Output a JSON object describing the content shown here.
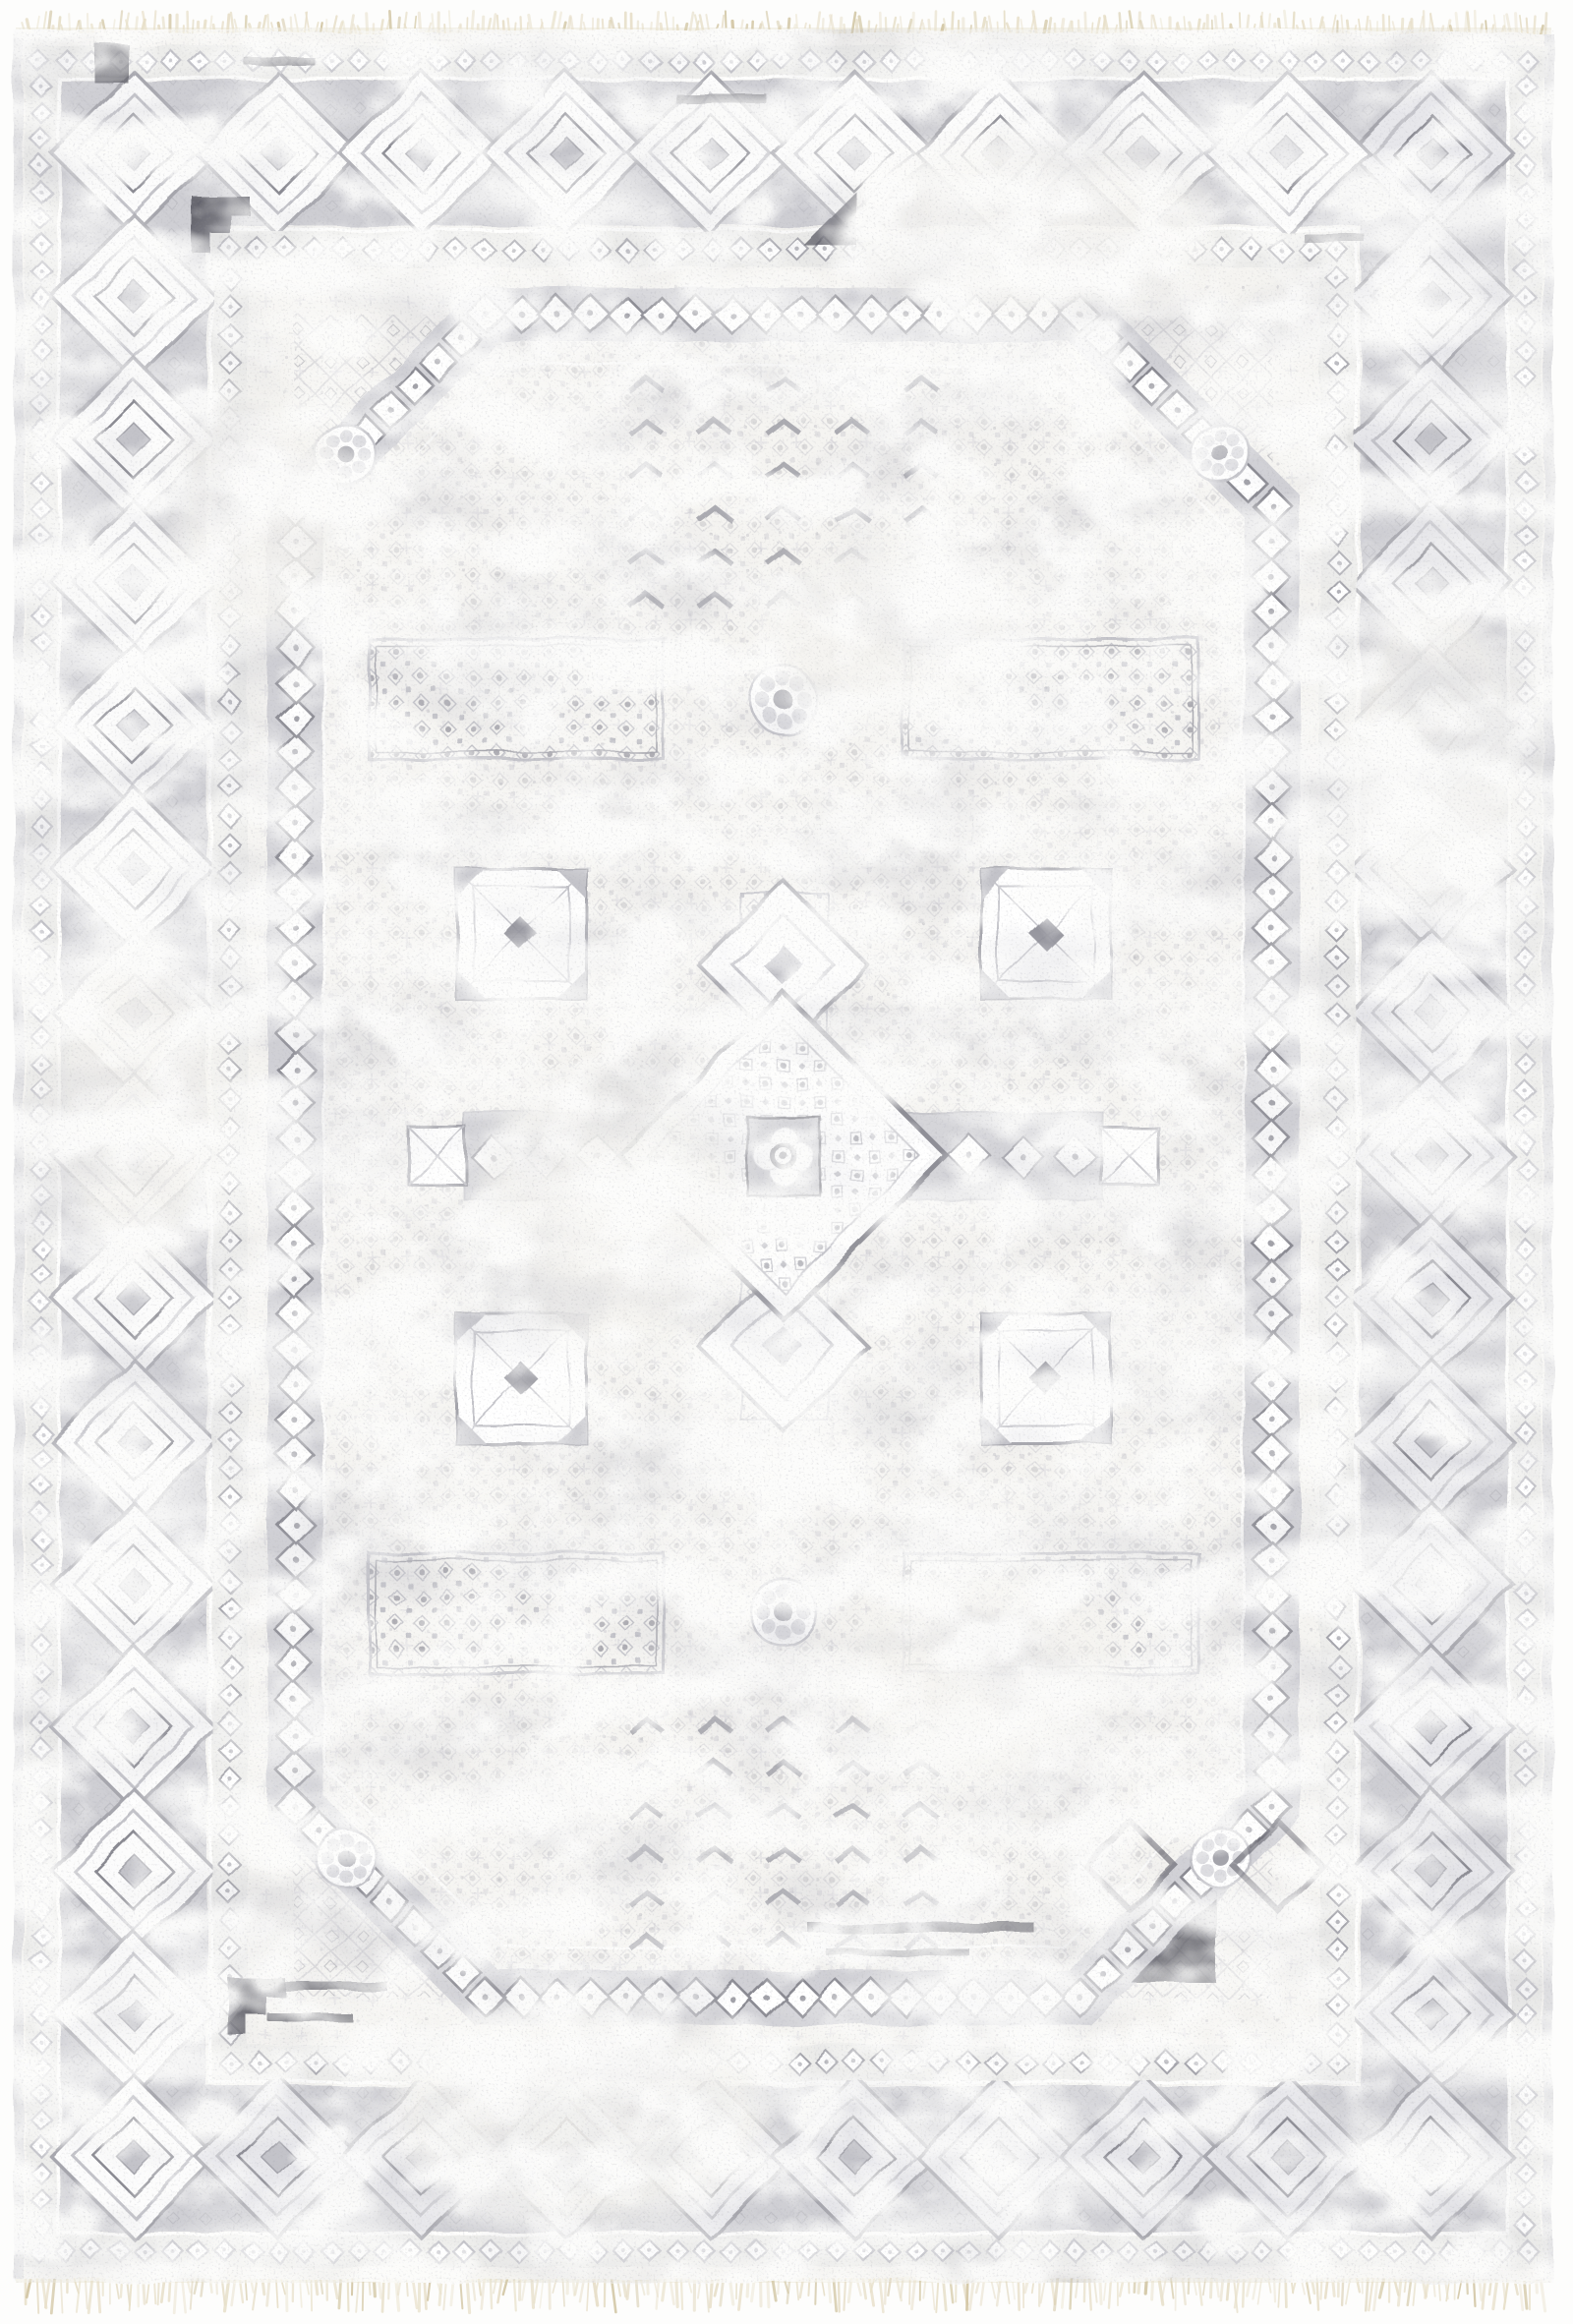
{
  "meta": {
    "description": "Product photograph of a distressed vintage-style traditional area rug in ivory and gray, with a central rosette medallion, stepped cross, repeating diamond borders and cream fringe on the top and bottom edges",
    "subject": "gray and ivory traditional medallion rug",
    "style": "distressed / faded tribal-traditional weave"
  },
  "rug": {
    "field_color_name": "ivory white",
    "pattern_color_name": "gray",
    "fringe_color_name": "cream",
    "border_motif": "repeating concentric diamond medallions",
    "inner_panel_motif": "diamond chain octagon panel",
    "center_motif": "rosette medallion with stepped lozenge and cross arms"
  },
  "palette": {
    "page_bg": "#fdfdfc",
    "rug_base": "#f5f4f1",
    "white": "#ffffff",
    "silver": "#dddde1",
    "gray_light": "#c3c3c9",
    "gray_mid": "#a4a4ab",
    "gray": "#8a8a92",
    "gray_dark": "#6b6b74",
    "charcoal": "#4f4f59",
    "border_ground": "#cfcfd4",
    "guard_ground": "#ececea",
    "field_tint": "#e9e9ec",
    "fringe": "#e7dfc9",
    "fringe_dark": "#d2c6a4",
    "edge_band": "#f2efe5"
  }
}
